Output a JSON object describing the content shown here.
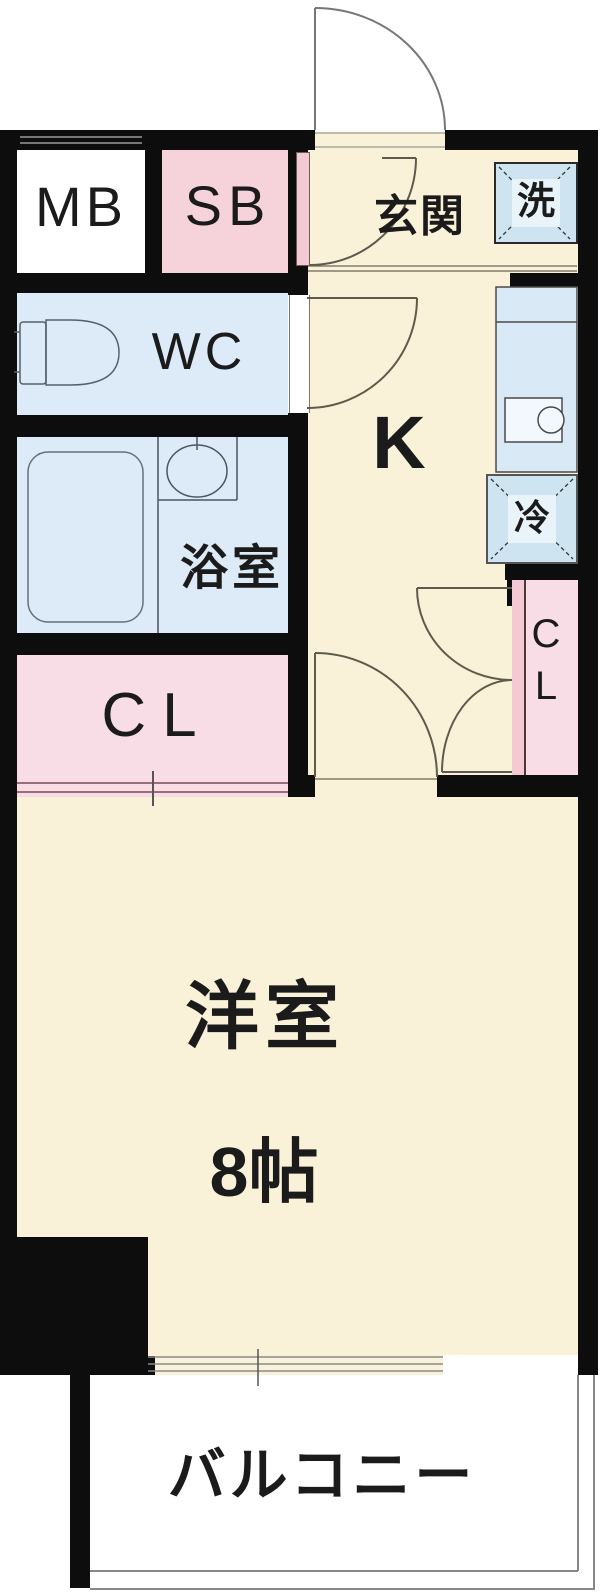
{
  "title": "1K apartment floor plan",
  "rooms": {
    "mb": "MB",
    "sb": "SB",
    "wc": "WC",
    "genkan": "玄関",
    "washer": "洗",
    "kitchen": "K",
    "fridge": "冷",
    "bathroom": "浴室",
    "closet_left": "CL",
    "closet_right": "CL",
    "western_room": "洋室",
    "western_room_size": "8帖",
    "balcony": "バルコニー"
  },
  "colors": {
    "wall": "#0d0d0d",
    "room_cream": "#faf1d9",
    "room_pink": "#f6d2db",
    "room_blue": "#dcebf7",
    "appliance_blue": "#cfe4f1",
    "balcony": "#ffffff"
  }
}
